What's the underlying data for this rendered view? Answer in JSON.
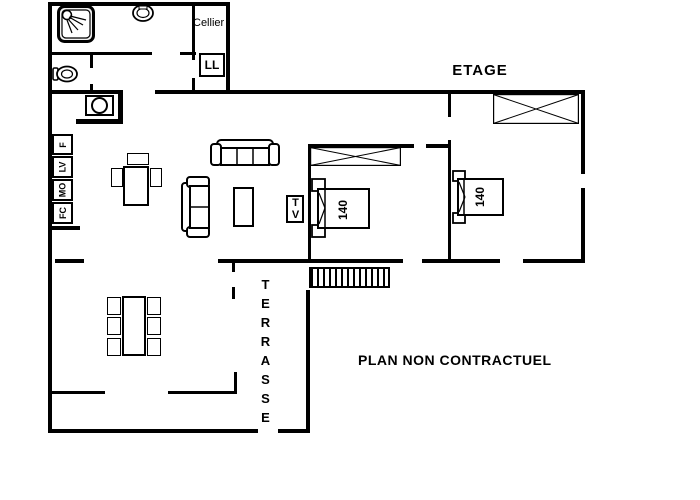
{
  "floor": {
    "title": "ETAGE",
    "disclaimer": "PLAN NON CONTRACTUEL"
  },
  "rooms": {
    "cellier": "Cellier",
    "terrasse": "TERRASSE"
  },
  "bedroom1": {
    "bed_size": "140",
    "tv_label": "TV"
  },
  "bedroom2": {
    "bed_size": "140"
  },
  "appliances": {
    "washing_machine": "LL",
    "fridge": "F",
    "dishwasher": "LV",
    "microwave": "MO",
    "oven": "FC"
  },
  "colors": {
    "wall": "#000000",
    "background": "#ffffff",
    "text": "#000000"
  },
  "icons": {
    "shower": "shower-top-view",
    "washbasin": "basin-top-view",
    "toilet": "toilet-side-view",
    "hob": "circle-in-box",
    "stairs": "hatched-bar",
    "wardrobe": "crossed-rectangle",
    "roof_window": "crossed-rectangle"
  }
}
